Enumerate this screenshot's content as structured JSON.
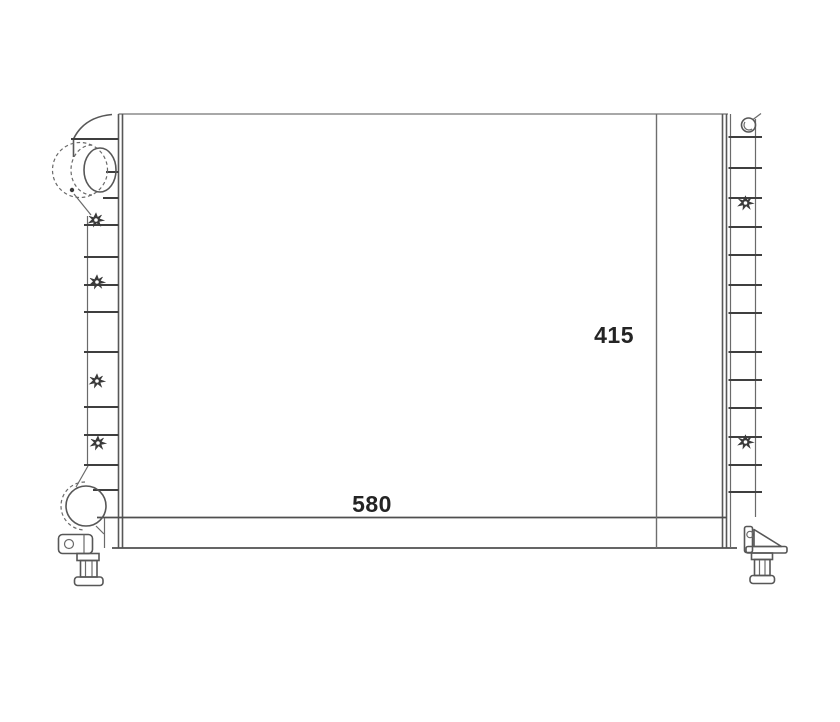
{
  "drawing": {
    "name": "radiator-technical-line-drawing",
    "labels": {
      "core_width": "580",
      "core_height": "415"
    },
    "colors": {
      "background": "#ffffff",
      "line_dark": "#3f3f3f",
      "line_mid": "#575757",
      "line_light": "#8c8c8c",
      "dimension_line": "#6e6e6e",
      "text": "#242424"
    }
  }
}
